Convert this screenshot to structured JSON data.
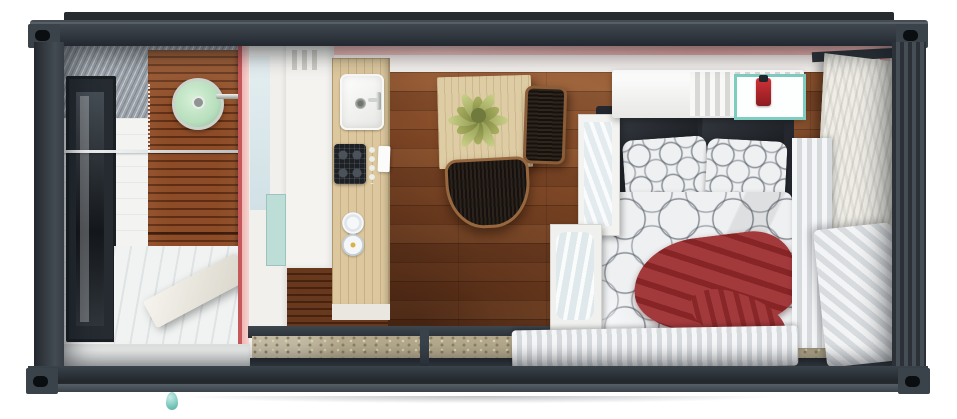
{
  "scene": {
    "label": "Top-down cutaway 3D render of a shipping-container tiny house interior with bathroom, kitchen, dining area and bedroom",
    "type": "3d-render-top-view",
    "palette": {
      "frame": "#2e343b",
      "corrugate": "#9ba2a9",
      "pink": "#eeaeab",
      "red_edge": "#c5585a",
      "wood_mid": "#8a4f2b",
      "slat": "#8d4c27",
      "counter": "#dcc79e",
      "mint": "#b7dfbd",
      "teal": "#bcded7",
      "glass": "#dfeaf0",
      "duvet": "#eef0f2",
      "red": "#a23a3c",
      "gravel": "#b3a88c",
      "curtain_hi": "#f5f6f7",
      "curtain_lo": "#d6dadd",
      "door": "#efede6",
      "plant": "#c9cf86",
      "linen": "#e3ebee",
      "drip": "#7fccc0"
    },
    "exterior": {
      "structure": "shipping-container-frame",
      "parts": [
        "top-rail",
        "bottom-rail",
        "left-wall",
        "right-wall",
        "corner-castings",
        "gravel-ground",
        "teal-drip"
      ]
    },
    "rooms": {
      "bathroom": {
        "name": "bathroom",
        "objects": [
          "black-framed-window",
          "corrugated-wall",
          "wood-slat-shower-wall",
          "mint-rain-shower-head",
          "glass-partition",
          "white-open-door",
          "tile-floor"
        ]
      },
      "kitchen": {
        "name": "kitchen",
        "objects": [
          "upper-cabinets",
          "white-sink",
          "gas-stove",
          "stove-knobs",
          "wood-countertop",
          "towel",
          "plates",
          "teal-panel"
        ]
      },
      "dining": {
        "name": "dining-area",
        "objects": [
          "light-wood-table",
          "green-potted-plant",
          "wire-chair-east",
          "wire-chair-south"
        ]
      },
      "bedroom": {
        "name": "bedroom",
        "objects": [
          "double-bed",
          "black-pillows",
          "circle-pattern-pillows",
          "circle-pattern-duvet",
          "red-blanket",
          "open-storage-drawers",
          "white-radiator-shelf",
          "fire-extinguisher",
          "safety-card",
          "vertical-curtain",
          "corner-curtain",
          "bottom-curtain",
          "marble-open-door"
        ]
      }
    }
  }
}
